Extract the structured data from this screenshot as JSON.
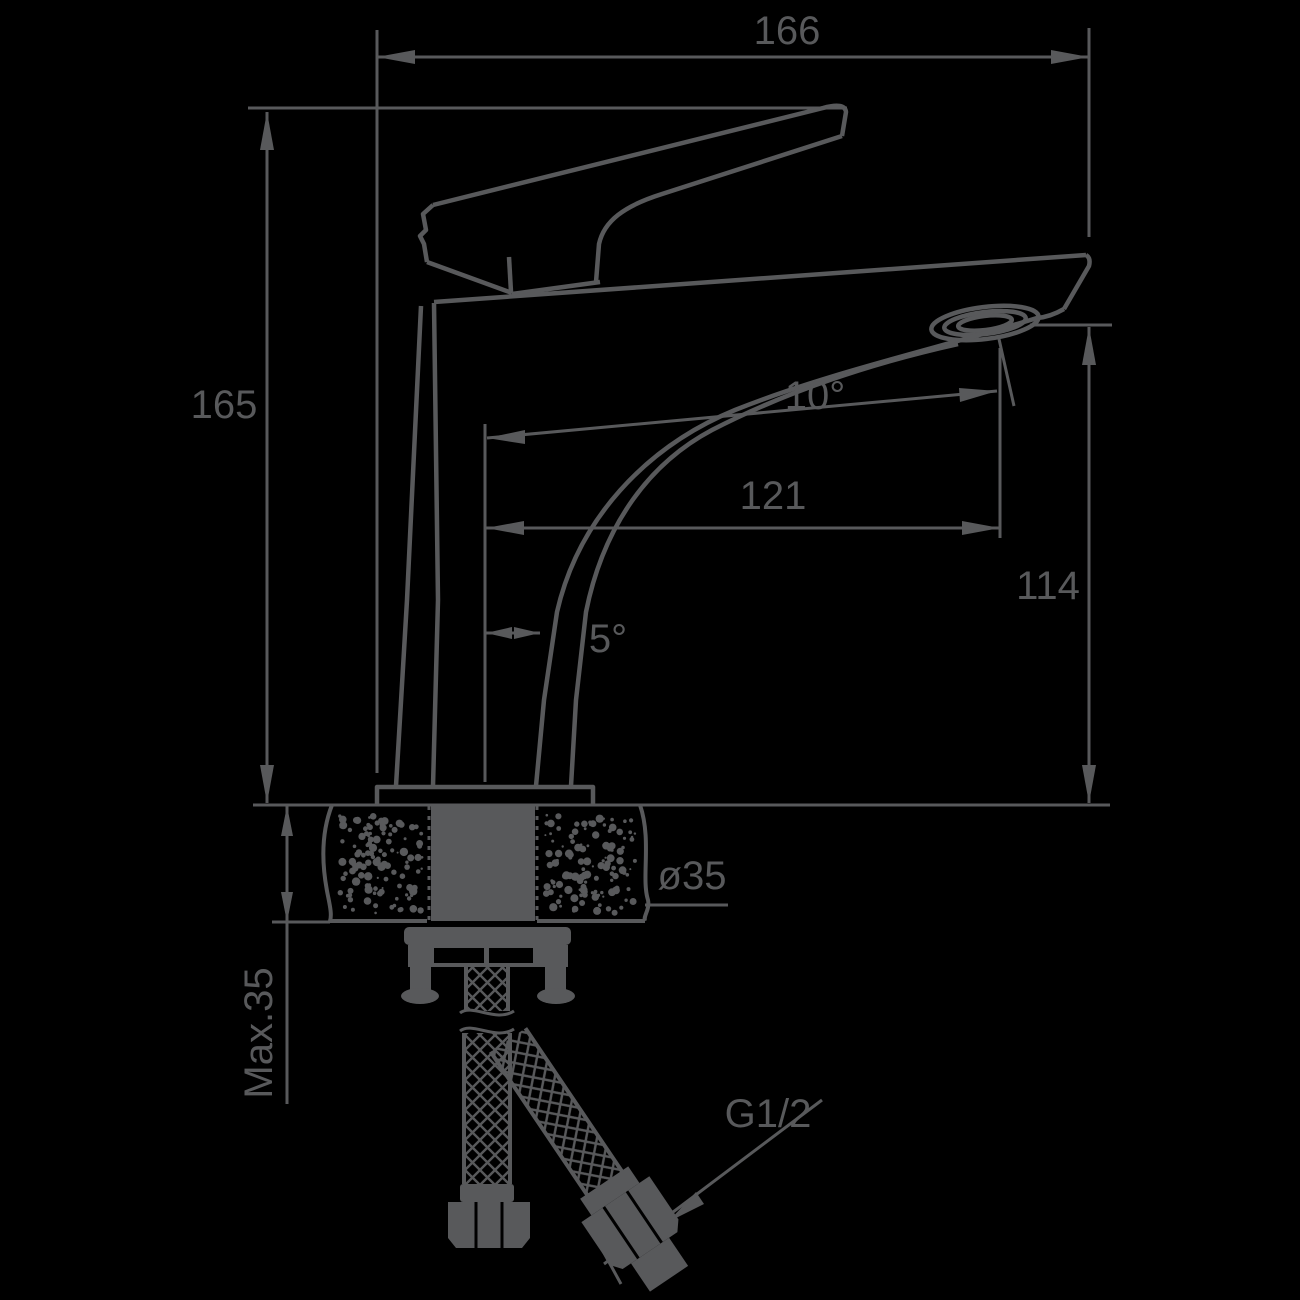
{
  "drawing": {
    "kind": "faucet-installation-dimension-drawing",
    "colors": {
      "background": "#000000",
      "line": "#58595b"
    },
    "labels": {
      "overall_width": "166",
      "overall_height": "165",
      "spout_angle": "10°",
      "spout_reach": "121",
      "spout_outlet_height": "114",
      "body_tilt_angle": "5°",
      "mounting_hole_diameter": "ø35",
      "max_deck_thickness": "Max.35",
      "connection_thread": "G1/2"
    }
  }
}
